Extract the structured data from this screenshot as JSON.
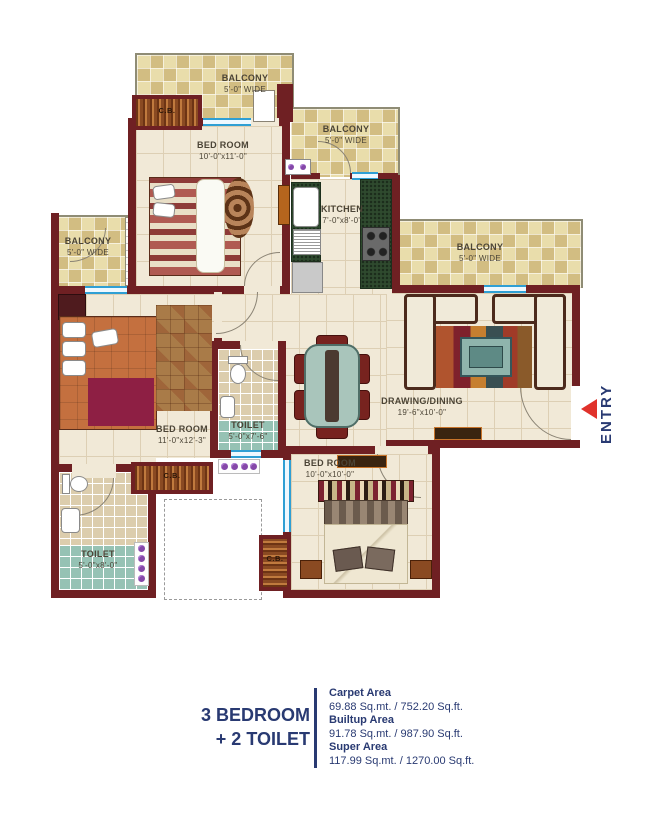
{
  "rooms": {
    "balcony_top": {
      "name": "BALCONY",
      "dims": "5'-0\" WIDE"
    },
    "balcony_mid": {
      "name": "BALCONY",
      "dims": "5'-0\" WIDE"
    },
    "balcony_right": {
      "name": "BALCONY",
      "dims": "5'-0\" WIDE"
    },
    "balcony_left": {
      "name": "BALCONY",
      "dims": "5'-0\" WIDE"
    },
    "bedroom_top": {
      "name": "BED ROOM",
      "dims": "10'-0\"x11'-0\""
    },
    "kitchen": {
      "name": "KITCHEN",
      "dims": "7'-0\"x8'-0\""
    },
    "bedroom_left": {
      "name": "BED ROOM",
      "dims": "11'-0\"x12'-3\""
    },
    "toilet_mid": {
      "name": "TOILET",
      "dims": "5'-0\"x7'-6\""
    },
    "toilet_left": {
      "name": "TOILET",
      "dims": "5'-0\"x8'-0\""
    },
    "bedroom_bottom": {
      "name": "BED ROOM",
      "dims": "10'-0\"x10'-0\""
    },
    "drawing_dining": {
      "name": "DRAWING/DINING",
      "dims": "19'-6\"x10'-0\""
    },
    "cupboard": {
      "label": "C.B."
    }
  },
  "entry": {
    "label": "ENTRY"
  },
  "summary": {
    "title_line1": "3 BEDROOM",
    "title_line2": "+ 2 TOILET",
    "areas": [
      {
        "label": "Carpet Area",
        "value": "69.88 Sq.mt. / 752.20 Sq.ft."
      },
      {
        "label": "Builtup Area",
        "value": "91.78 Sq.mt. / 987.90 Sq.ft."
      },
      {
        "label": "Super Area",
        "value": "117.99 Sq.mt. / 1270.00 Sq.ft."
      }
    ]
  },
  "colors": {
    "wall": "#6f2023",
    "navy": "#293a72",
    "entry_red": "#e0322b",
    "window_blue": "#2f9fd4"
  }
}
